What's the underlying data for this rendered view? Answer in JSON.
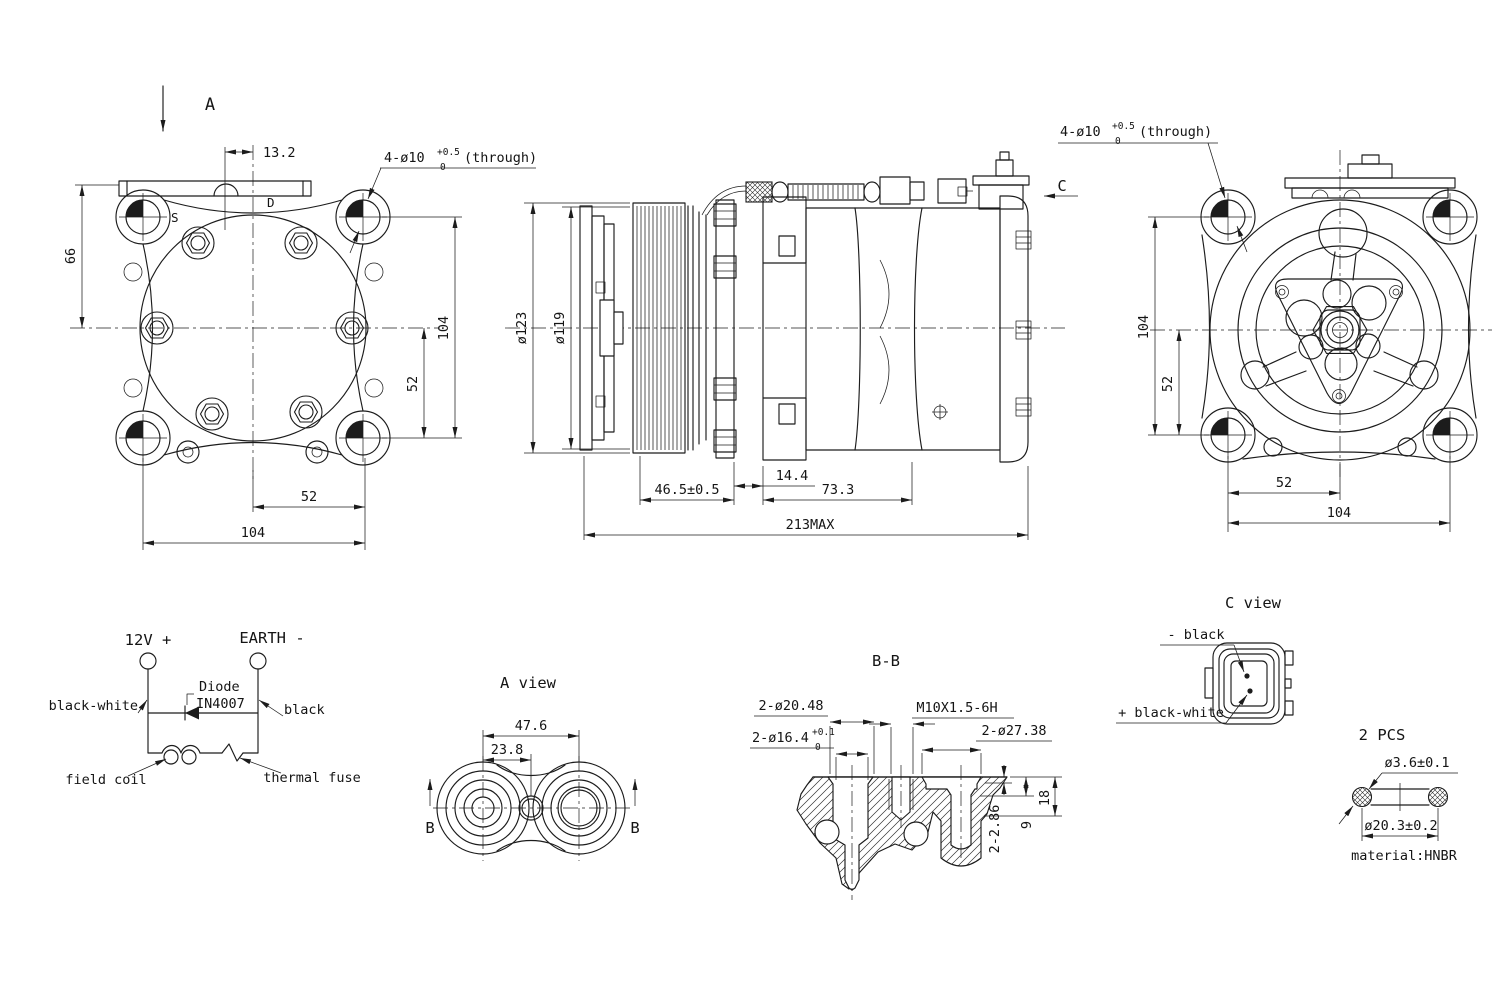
{
  "views": {
    "front": {
      "direction_label": "A",
      "dim_13_2": "13.2",
      "hole_note_prefix": "4-ø10",
      "hole_note_tol_up": "+0.5",
      "hole_note_tol_dn": "0",
      "hole_note_suffix": "(through)",
      "port_s": "S",
      "port_d": "D",
      "dim_66": "66",
      "dim_v104": "104",
      "dim_v52": "52",
      "dim_h52": "52",
      "dim_h104": "104"
    },
    "side": {
      "direction_label": "C",
      "dim_od": "ø123",
      "dim_pd": "ø119",
      "dim_14_4": "14.4",
      "dim_46_5": "46.5±0.5",
      "dim_73_3": "73.3",
      "dim_total": "213MAX"
    },
    "rear": {
      "hole_note_prefix": "4-ø10",
      "hole_note_tol_up": "+0.5",
      "hole_note_tol_dn": "0",
      "hole_note_suffix": "(through)",
      "dim_v104": "104",
      "dim_v52": "52",
      "dim_h52": "52",
      "dim_h104": "104"
    }
  },
  "schematic": {
    "terminal_positive": "12V +",
    "terminal_negative": "EARTH -",
    "diode_line1": "Diode",
    "diode_line2": "IN4007",
    "wire_positive": "black-white",
    "wire_negative": "black",
    "field_coil": "field coil",
    "thermal_fuse": "thermal fuse"
  },
  "a_view": {
    "title": "A view",
    "dim_47_6": "47.6",
    "dim_23_8": "23.8",
    "section_marker_left": "B",
    "section_marker_right": "B"
  },
  "bb_section": {
    "title": "B-B",
    "note_20_48": "2-ø20.48",
    "note_16_4_prefix": "2-ø16.4",
    "note_16_4_tol_up": "+0.1",
    "note_16_4_tol_dn": "0",
    "thread_note": "M10X1.5-6H",
    "note_27_38": "2-ø27.38",
    "dim_2_86": "2-2.86",
    "dim_9": "9",
    "dim_18": "18"
  },
  "c_view": {
    "title": "C view",
    "pin_negative": "- black",
    "pin_positive": "+ black-white"
  },
  "seal_detail": {
    "quantity": "2 PCS",
    "dim_cross_section": "ø3.6±0.1",
    "dim_ring": "ø20.3±0.2",
    "material": "material:HNBR"
  }
}
